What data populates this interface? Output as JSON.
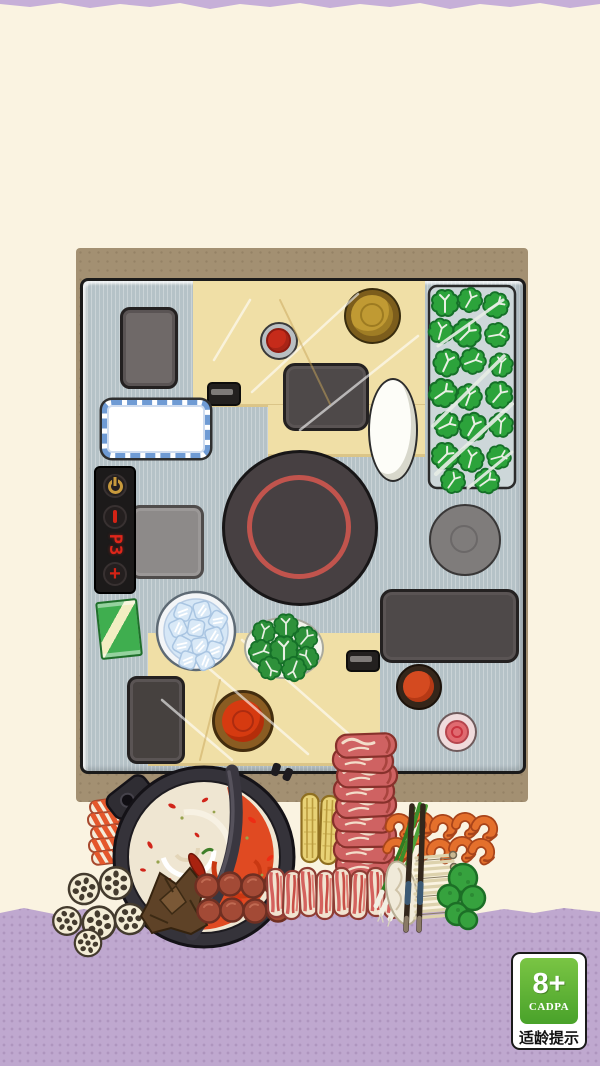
{
  "stove_panel": {
    "display_value": "P3",
    "plus_label": "+"
  },
  "age_badge": {
    "rating": "8+",
    "authority": "CADPA",
    "caption": "适龄提示"
  },
  "icons": {
    "power_icon": "ring-with-top-bar",
    "minus_icon": "red-vertical-bar",
    "plus_icon": "+"
  },
  "colors": {
    "background_cream": "#faf3e1",
    "purple_band": "#bfa8cf",
    "mat_brown": "#a39072",
    "table_metal": "#b5c2c7",
    "board_wood": "#f0dfa6",
    "cooktop_body": "#474042",
    "cooktop_ring_red": "#c1544d",
    "broth_white": "#efe6d2",
    "broth_red": "#e04a22",
    "greens_green": "#2ca33b",
    "panel_display_red": "#e0261a",
    "panel_gold": "#c89a3c",
    "badge_green": "#49a22a",
    "sauce_red": "#d63a10"
  }
}
